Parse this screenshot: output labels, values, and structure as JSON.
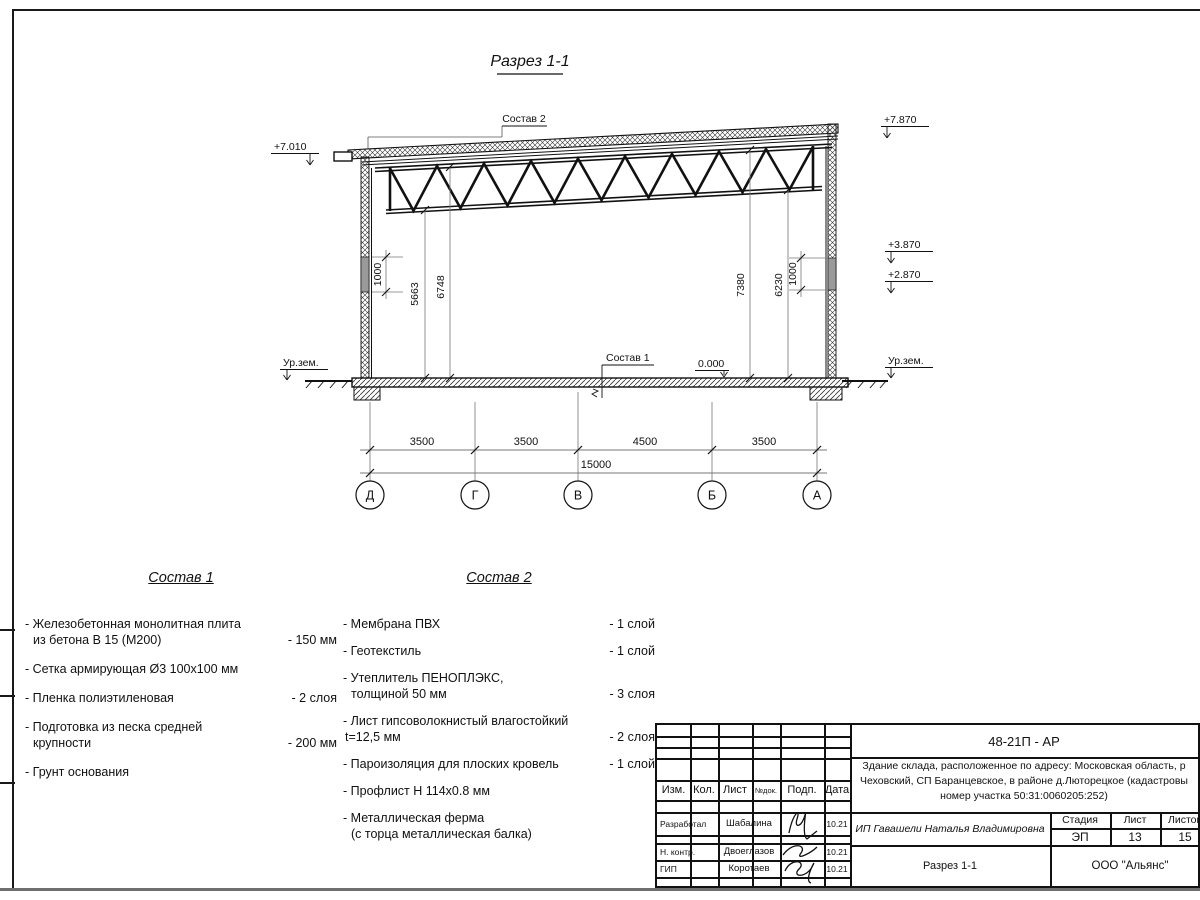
{
  "drawing": {
    "title": "Разрез 1-1",
    "sostav2_label": "Состав 2",
    "sostav1_label": "Состав 1",
    "elev_left_top": "+7.010",
    "elev_right_top": "+7.870",
    "elev_right_38": "+3.870",
    "elev_right_28": "+2.870",
    "elev_zero": "0.000",
    "ground_left": "Ур.зем.",
    "ground_right": "Ур.зем.",
    "dim_1000_left": "1000",
    "dim_5663": "5663",
    "dim_6748": "6748",
    "dim_7380": "7380",
    "dim_6230": "6230",
    "dim_1000_right": "1000",
    "span_dims": [
      "3500",
      "3500",
      "4500",
      "3500"
    ],
    "total_span": "15000",
    "axes": [
      "Д",
      "Г",
      "В",
      "Б",
      "А"
    ]
  },
  "sostav1": {
    "header": "Состав 1",
    "items": [
      {
        "l1": "- Железобетонная  монолитная плита",
        "l2": "из бетона В 15 (М200)",
        "value": "- 150 мм"
      },
      {
        "l1": "- Сетка армирующая Ø3 100х100 мм",
        "l2": "",
        "value": ""
      },
      {
        "l1": "- Пленка полиэтиленовая",
        "l2": "",
        "value": "-  2 слоя"
      },
      {
        "l1": "- Подготовка из песка средней",
        "l2": "крупности",
        "value": "- 200 мм"
      },
      {
        "l1": "- Грунт основания",
        "l2": "",
        "value": ""
      }
    ]
  },
  "sostav2": {
    "header": "Состав 2",
    "items": [
      {
        "l1": "- Мембрана ПВХ",
        "l2": "",
        "value": "- 1 слой"
      },
      {
        "l1": "- Геотекстиль",
        "l2": "",
        "value": "- 1 слой"
      },
      {
        "l1": "- Утеплитель ПЕНОПЛЭКС,",
        "l2": "толщиной 50 мм",
        "value": "- 3 слоя"
      },
      {
        "l1": "- Лист гипсоволокнистый влагостойкий",
        "l2": "t=12,5 мм",
        "value": "- 2 слоя"
      },
      {
        "l1": "- Пароизоляция для плоских кровель",
        "l2": "",
        "value": "- 1 слой"
      },
      {
        "l1": "- Профлист Н 114х0.8 мм",
        "l2": "",
        "value": ""
      },
      {
        "l1": "- Металлическая ферма",
        "l2": "(с торца металлическая балка)",
        "value": ""
      }
    ]
  },
  "titleblock": {
    "doc_number": "48-21П - АР",
    "project_line1": "Здание склада, расположенное по адресу: Московская область, р",
    "project_line2": "Чеховский, СП Баранцевское, в районе д.Люторецкое  (кадастровы",
    "project_line3": "номер участка 50:31:0060205:252)",
    "cols": [
      "Изм.",
      "Кол.",
      "Лист",
      "№док.",
      "Подп.",
      "Дата"
    ],
    "rows": [
      {
        "role": "Разработал",
        "name": "Шабалина",
        "date": "10.21"
      },
      {
        "role": "Н. контр.",
        "name": "Двоеглазов",
        "date": "10.21"
      },
      {
        "role": "ГИП",
        "name": "Коротаев",
        "date": "10.21"
      }
    ],
    "customer": "ИП Гавашели Наталья Владимировна",
    "stage_label": "Стадия",
    "sheet_label": "Лист",
    "sheets_label": "Листов",
    "stage": "ЭП",
    "sheet_no": "13",
    "sheets_total": "15",
    "drawing_name": "Разрез 1-1",
    "company": "ООО \"Альянс\""
  }
}
